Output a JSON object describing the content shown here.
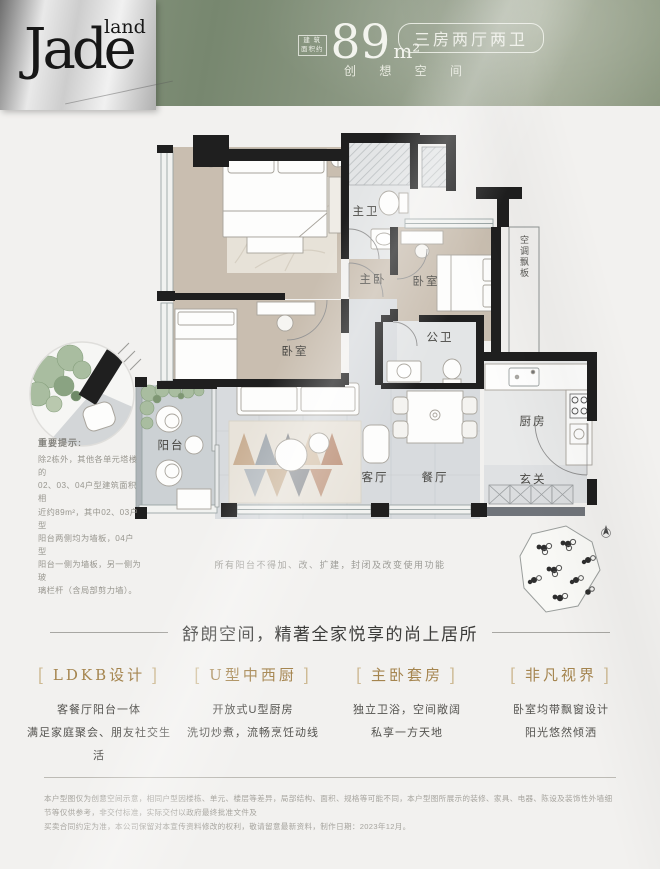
{
  "header": {
    "logo_main": "Jade",
    "logo_sub": "land",
    "area_label_line1": "建 筑",
    "area_label_line2": "面积约",
    "area_value": "89",
    "area_unit": "m²",
    "layout_badge": "三房两厅两卫",
    "slogan": "创 想 空 间"
  },
  "floorplan": {
    "rooms": {
      "master_bath": "主卫",
      "master_bedroom": "主卧",
      "bedroom_right": "卧室",
      "bedroom_left": "卧室",
      "guest_bath": "公卫",
      "ac_panel": "空调飘板",
      "balcony": "阳台",
      "living": "客厅",
      "dining": "餐厅",
      "kitchen": "厨房",
      "foyer": "玄关"
    },
    "notice_title": "重要提示:",
    "notice_lines": [
      "除2栋外，其他各单元塔楼的",
      "02、03、04户型建筑面积相",
      "近约89m²，其中02、03户型",
      "阳台两侧均为墙板，04户型",
      "阳台一侧为墙板，另一侧为玻",
      "璃栏杆（含局部剪力墙）。"
    ],
    "footnote": "所有阳台不得加、改、扩建，封闭及改变使用功能"
  },
  "tagline": "舒朗空间，精著全家悦享的尚上居所",
  "features": [
    {
      "title": "LDKB设计",
      "line1": "客餐厅阳台一体",
      "line2": "满足家庭聚会、朋友社交生活"
    },
    {
      "title": "U型中西厨",
      "line1": "开放式U型厨房",
      "line2": "洗切炒煮，流畅烹饪动线"
    },
    {
      "title": "主卧套房",
      "line1": "独立卫浴，空间敞阔",
      "line2": "私享一方天地"
    },
    {
      "title": "非凡视界",
      "line1": "卧室均带飘窗设计",
      "line2": "阳光悠然倾洒"
    }
  ],
  "footer": {
    "line1": "本户型图仅为创意空间示意，相同户型因楼栋、单元、楼层等差异，局部结构、面积、规格等可能不同，本户型图所展示的装修、家具、电器、陈设及装饰性外墙细节等仅供参考，非交付标准，实际交付以政府最终批准文件及",
    "line2": "买卖合同约定为准，本公司保留对本宣传资料修改的权利，敬请留意最新资料，制作日期：2023年12月。"
  },
  "colors": {
    "header_green": "#87947e",
    "logo_silver": "#d9d9d9",
    "accent_gold": "#a5854f",
    "wall_black": "#1f1f1f",
    "wood_floor": "#c9beb0",
    "marble_floor": "#d8dbde"
  }
}
